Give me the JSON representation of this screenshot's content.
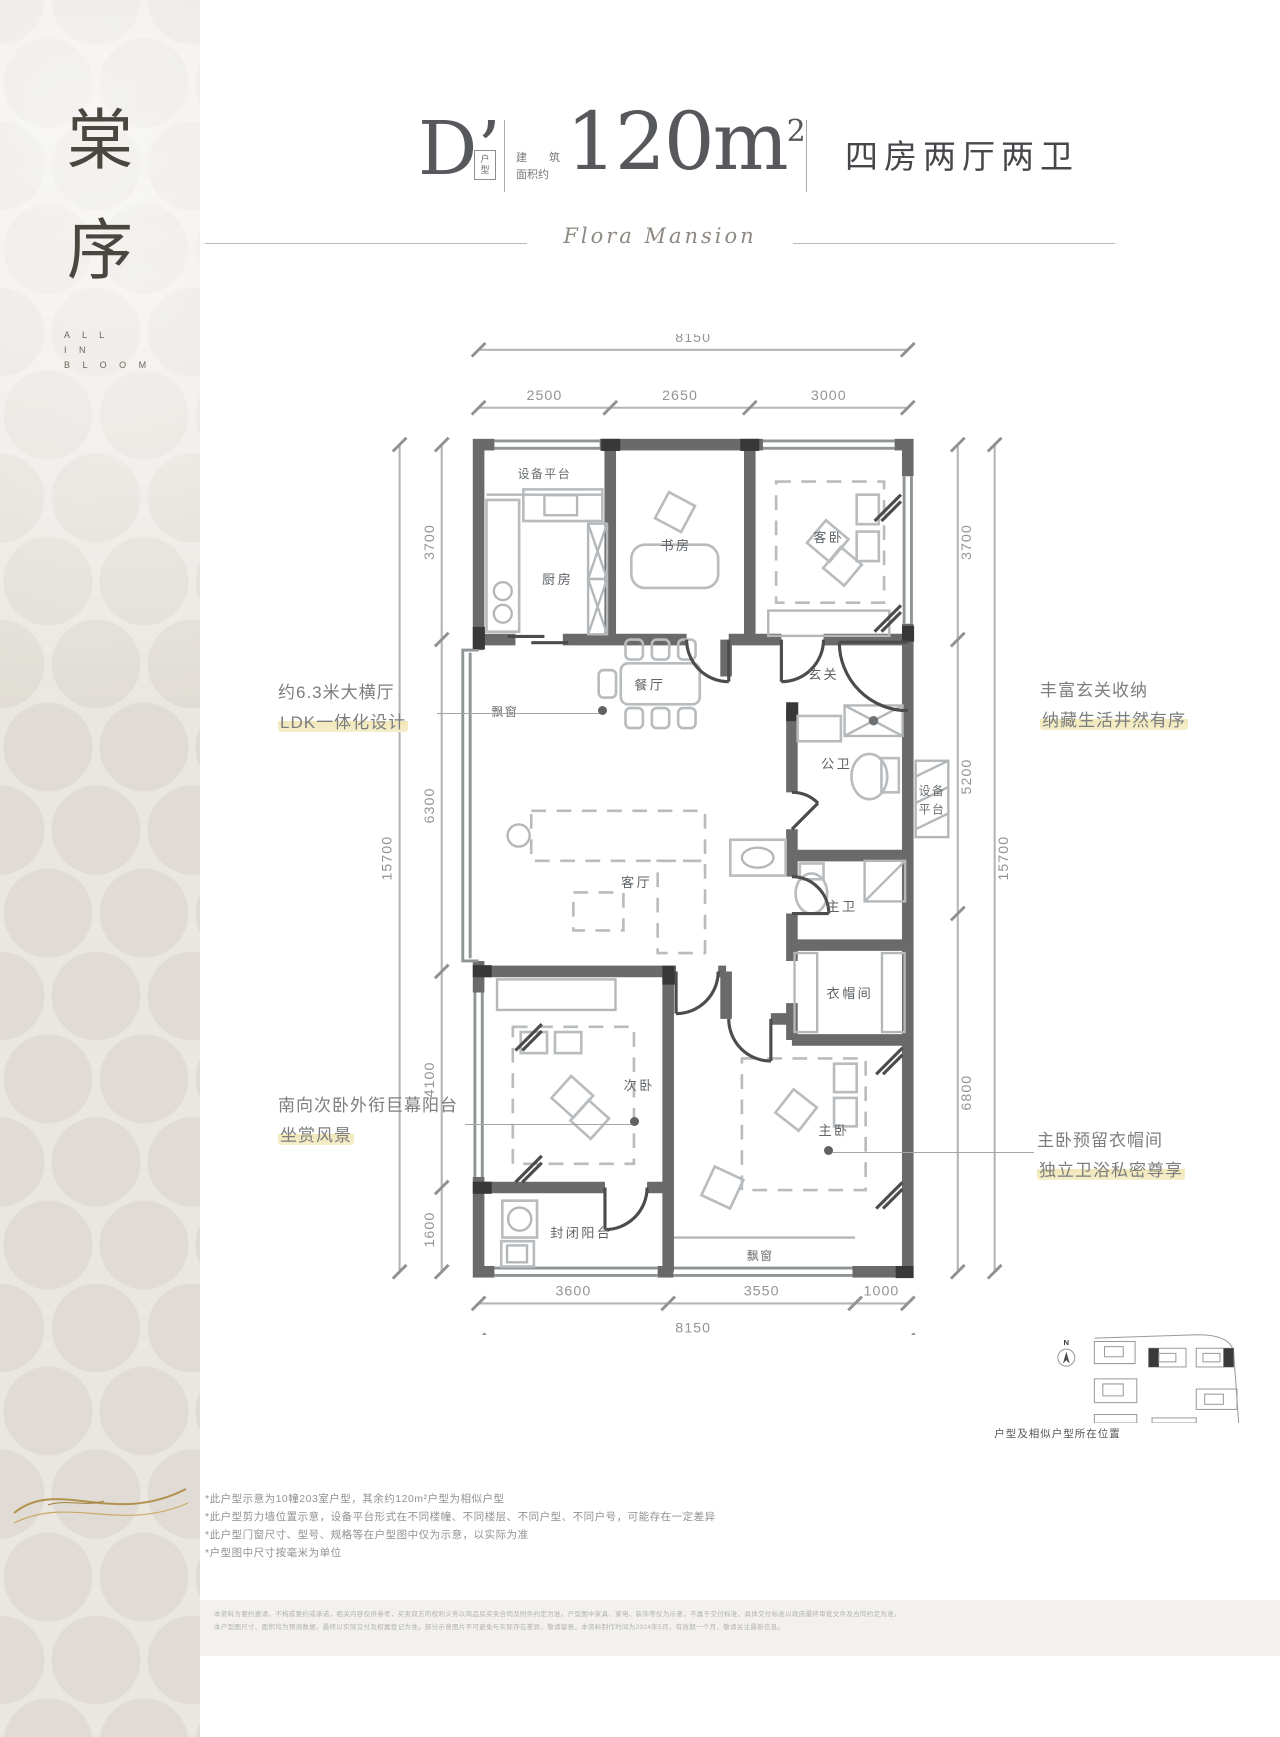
{
  "sidebar": {
    "title_chars": [
      "棠",
      "序"
    ],
    "motto_lines": [
      "A L L",
      "I N",
      "B L O O M"
    ]
  },
  "header": {
    "unit_code": "D’",
    "unit_tag": [
      "户",
      "型"
    ],
    "area_label_row1": [
      "建",
      "筑"
    ],
    "area_label_row2": "面积约",
    "area_value": "120m",
    "area_sup": "2",
    "layout_desc": "四房两厅两卫",
    "brand_script": "Flora Mansion"
  },
  "callouts": {
    "living": {
      "line1": "约6.3米大横厅",
      "line2": "LDK一体化设计"
    },
    "foyer": {
      "line1": "丰富玄关收纳",
      "line2": "纳藏生活井然有序"
    },
    "balcony": {
      "line1": "南向次卧外衔巨幕阳台",
      "line2": "坐赏风景"
    },
    "master": {
      "line1": "主卧预留衣帽间",
      "line2": "独立卫浴私密尊享"
    }
  },
  "plan": {
    "rooms": {
      "equip_top": "设备平台",
      "kitchen": "厨房",
      "study": "书房",
      "guest_bed": "客卧",
      "foyer": "玄关",
      "dining": "餐厅",
      "bay_left": "飘窗",
      "public_bath": "公卫",
      "equip_right_1": "设备",
      "equip_right_2": "平台",
      "living": "客厅",
      "master_bath": "主卫",
      "cloak": "衣帽间",
      "second_bed": "次卧",
      "master_bed": "主卧",
      "closed_balcony": "封闭阳台",
      "bay_bottom": "飘窗"
    },
    "dims": {
      "top_total": "8150",
      "top_seg_1": "2500",
      "top_seg_2": "2650",
      "top_seg_3": "3000",
      "left_seg_1": "3700",
      "left_seg_2": "6300",
      "left_seg_3": "4100",
      "left_seg_4": "1600",
      "left_total": "15700",
      "right_seg_1": "3700",
      "right_seg_2": "5200",
      "right_seg_3": "6800",
      "right_total": "15700",
      "bottom_seg_1": "3600",
      "bottom_seg_2": "3550",
      "bottom_seg_3": "1000",
      "bottom_total": "8150"
    }
  },
  "site_plan": {
    "compass": "N",
    "caption": "户型及相似户型所在位置"
  },
  "notes": {
    "n1": "*此户型示意为10幢203室户型，其余约120m²户型为相似户型",
    "n2": "*此户型剪力墙位置示意，设备平台形式在不同楼幢、不同楼层、不同户型、不同户号，可能存在一定差异",
    "n3": "*此户型门窗尺寸、型号、规格等在户型图中仅为示意，以实际为准",
    "n4": "*户型图中尺寸按毫米为单位"
  },
  "footer": {
    "line1": "本资料为要约邀请，不构成要约或承诺，相关内容仅供参考，买卖双方的权利义务以商品房买卖合同及附件约定为准。户型图中家具、家电、装饰等仅为示意，不属于交付标准，具体交付标准以政府最终审批文件及合同约定为准。",
    "line2": "本户型图尺寸、面积均为预测数据，最终以实际交付及权属登记为准。部分示意图片不可避免与实际存在差异，敬请留意。本资料制作时间为2024年5月，有效期一个月，敬请关注最新信息。"
  }
}
